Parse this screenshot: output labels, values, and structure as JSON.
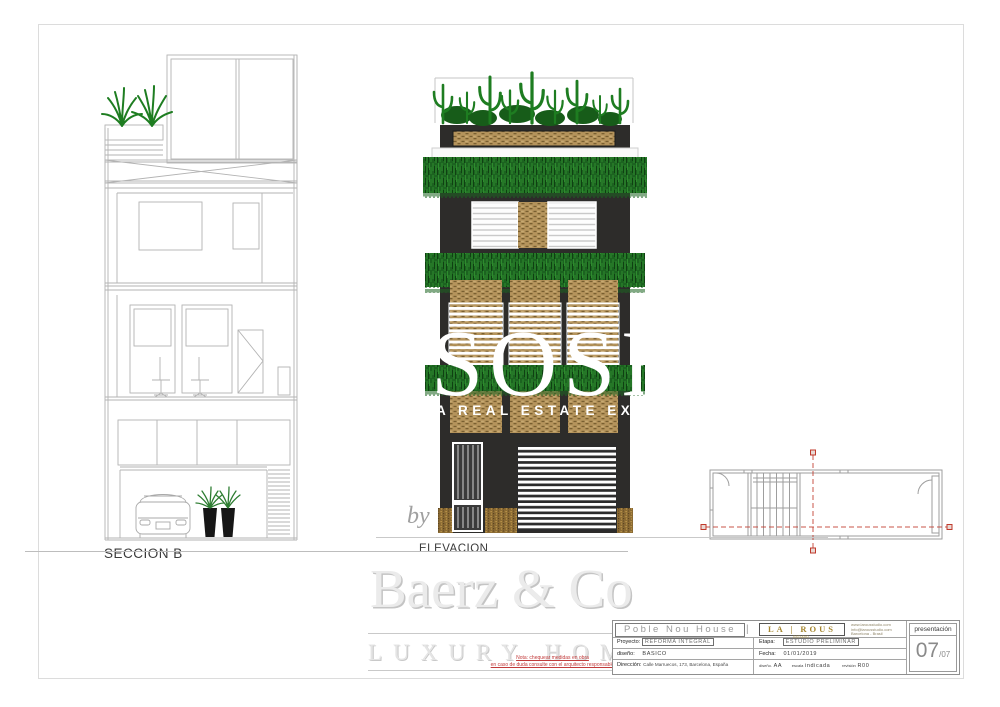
{
  "drawings": {
    "section_label": "SECCION B",
    "elevation_label": "ELEVACION"
  },
  "watermarks": {
    "sosh": "SOSH",
    "tagline": "A REAL ESTATE EXPER",
    "by": "by",
    "brand": "Baerz & Co",
    "brand_sub": "LUXURY HOMES",
    "note1": "Nota: chequear medidas en obra",
    "note2": "en caso de duda consulte con el arquitecto responsable"
  },
  "title_block": {
    "project_title": "Poble Nou House",
    "divider": "|",
    "logo": "LA | ROUS",
    "logo_sub": "ESTUDIO",
    "contact": [
      "www.larousstudio.com",
      "info@larousstudio.com",
      "Barcelona - Brasil"
    ],
    "presentacion": "presentación",
    "sheet_no": "07",
    "sheet_total": "/07",
    "proyecto_label": "Proyecto:",
    "proyecto_value": "REFORMA INTEGRAL",
    "diseno_label": "diseño:",
    "diseno_value": "BASICO",
    "direccion_label": "Dirección:",
    "direccion_value": "Calle Marruecos, 173, Barcelona, España",
    "etapa_label": "Etapa:",
    "etapa_value": "ESTUDIO PRELIMINAR",
    "fecha_label": "Fecha:",
    "fecha_value": "01/01/2019",
    "dibujo_label": "diseño.",
    "dibujo_value": "AA",
    "escala_label": "escala",
    "escala_value": "indicada",
    "revision_label": "revisión",
    "revision_value": "R00"
  },
  "colors": {
    "facade": "#2d2c2a",
    "brick": "#b5945c",
    "brickdark": "#6e5628",
    "plant": "#1e7d21",
    "plantdark": "#175c19",
    "veg": "#1c6320",
    "vegline": "#2e8b2e",
    "gold": "#8a6a33",
    "goldlight": "#c8a050",
    "linework": "#b3b3b3",
    "planwall": "#9e9e9e",
    "cutred": "#c0392b"
  }
}
